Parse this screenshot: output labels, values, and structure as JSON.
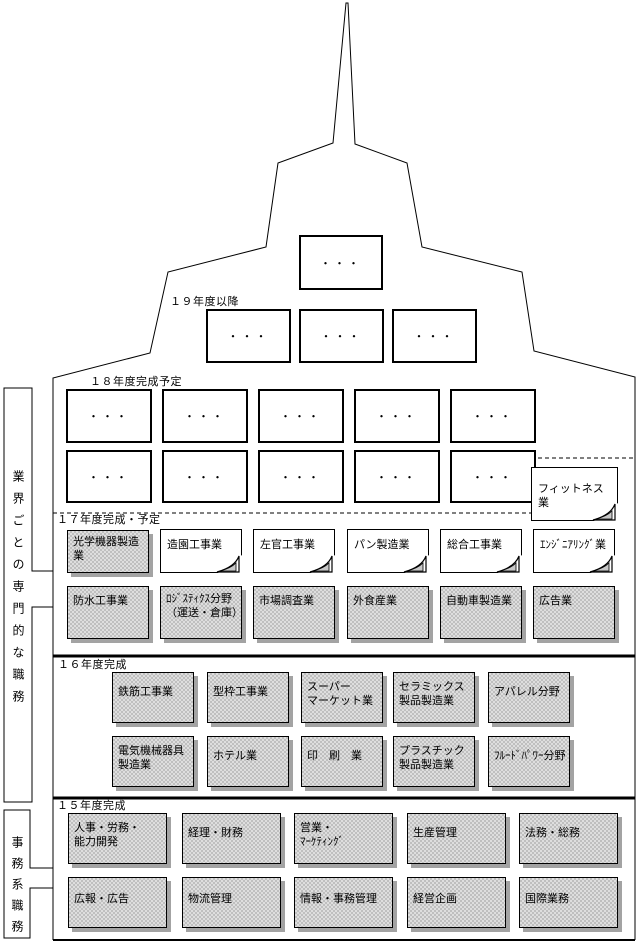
{
  "brackets": {
    "industry": {
      "label": "業界ごとの専門的な職務"
    },
    "clerical": {
      "label": "事務系職務"
    }
  },
  "sections": {
    "fy19": {
      "label": "１９年度以降",
      "boxes": [
        "・・・",
        "・・・",
        "・・・",
        "・・・"
      ]
    },
    "fy18": {
      "label": "１８年度完成予定",
      "boxes": [
        "・・・",
        "・・・",
        "・・・",
        "・・・",
        "・・・",
        "・・・",
        "・・・",
        "・・・",
        "・・・",
        "・・・"
      ]
    },
    "fy17": {
      "label": "１７年度完成・予定",
      "row1": [
        "光学機器製造\n業",
        "造園工事業",
        "左官工事業",
        "パン製造業",
        "総合工事業",
        "ｴﾝｼﾞﾆｱﾘﾝｸﾞ業"
      ],
      "row2": [
        "防水工事業",
        "ﾛｼﾞｽﾃｨｸｽ分野\n（運送・倉庫）",
        "市場調査業",
        "外食産業",
        "自動車製造業",
        "広告業"
      ]
    },
    "fy16": {
      "label": "１６年度完成",
      "row1": [
        "鉄筋工事業",
        "型枠工事業",
        "スーパー\nマーケット業",
        "セラミックス\n製品製造業",
        "アパレル分野"
      ],
      "row2": [
        "電気機械器具\n製造業",
        "ホテル業",
        "印　刷　業",
        "プラスチック\n製品製造業",
        "ﾌﾙｰﾄﾞﾊﾟﾜｰ分野"
      ]
    },
    "fy15": {
      "label": "１５年度完成",
      "row1": [
        "人事・労務・\n能力開発",
        "経理・財務",
        "営業・\nﾏｰｹﾃｨﾝｸﾞ",
        "生産管理",
        "法務・総務"
      ],
      "row2": [
        "広報・広告",
        "物流管理",
        "情報・事務管理",
        "経営企画",
        "国際業務"
      ]
    },
    "fitness": {
      "label": "フィットネス業"
    }
  }
}
